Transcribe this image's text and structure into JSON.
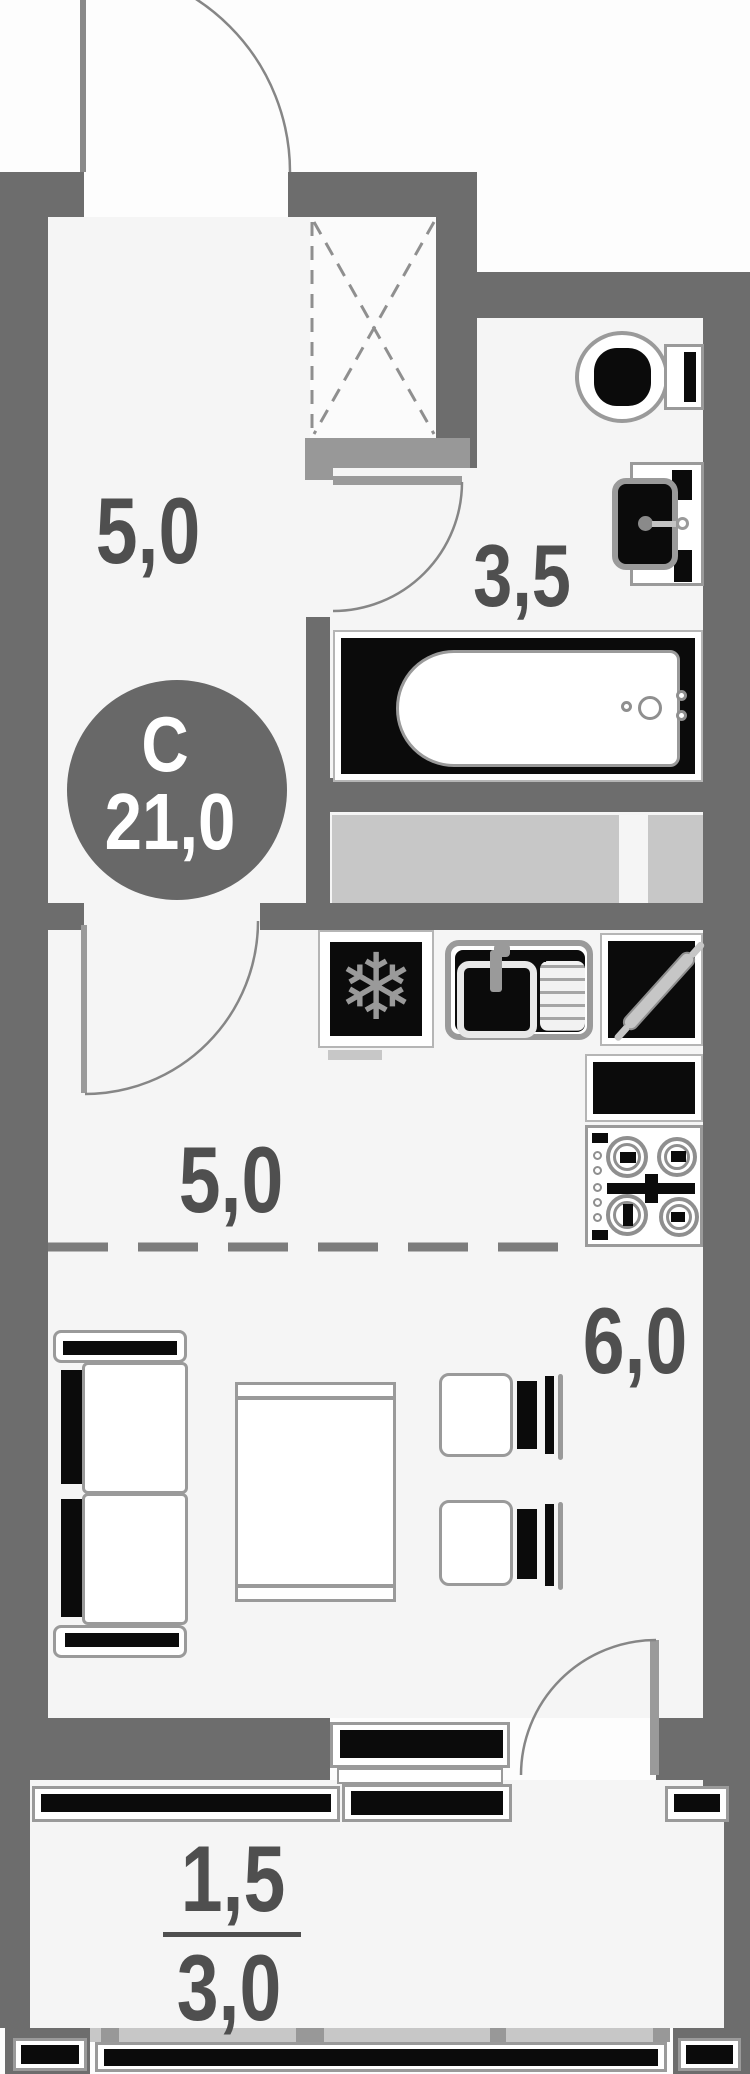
{
  "title": "Studio apartment floor plan",
  "badge": {
    "north_letter": "С",
    "total_area": "21,0"
  },
  "rooms": {
    "hallway": {
      "area": "5,0"
    },
    "bathroom": {
      "area": "3,5"
    },
    "kitchen": {
      "area": "5,0"
    },
    "living_room": {
      "area": "6,0"
    },
    "balcony": {
      "area_coefficient": "1,5",
      "area_full": "3,0"
    }
  },
  "icons": {
    "snowflake": "❄"
  },
  "fixtures": [
    "entry-door",
    "ventilation-shaft",
    "toilet",
    "washbasin",
    "bathtub",
    "refrigerator",
    "kitchen-sink",
    "cutting-board-rolling-pin",
    "oven",
    "stove-4-burners",
    "sofa",
    "table",
    "chair",
    "chair",
    "balcony-door",
    "balcony-glazing"
  ],
  "colors": {
    "wall": "#6d6d6d",
    "wall_light": "#989898",
    "counter": "#c7c7c7",
    "fixture_black": "#0b0b0b",
    "line": "#868686",
    "text": "#4f4f4f",
    "badge_bg": "#686868",
    "room_tint": "#f5f5f5"
  }
}
